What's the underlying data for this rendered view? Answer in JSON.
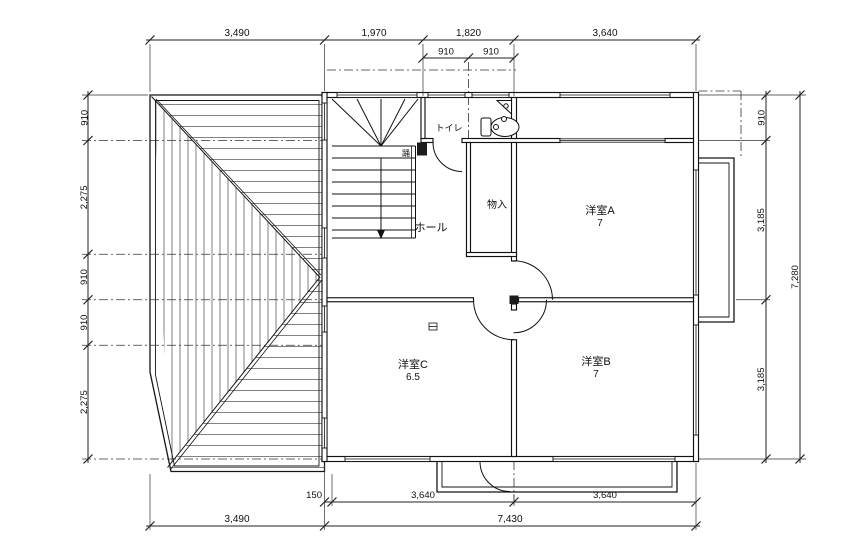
{
  "drawing": {
    "type": "architectural-floor-plan",
    "colors": {
      "line": "#1a1a1a",
      "background": "#ffffff"
    },
    "dims": {
      "top": [
        "3,490",
        "1,970",
        "1,820",
        "3,640"
      ],
      "top_sub": [
        "910",
        "910"
      ],
      "left": [
        "910",
        "2,275",
        "910",
        "910",
        "2,275"
      ],
      "right": [
        "910",
        "3,185",
        "3,185"
      ],
      "right_total": "7,280",
      "bottom_sub": [
        "150",
        "3,640",
        "3,640"
      ],
      "bottom": [
        "3,490",
        "7,430"
      ]
    },
    "rooms": {
      "toilet": "トイレ",
      "hall": "ホール",
      "storage": "物入",
      "room_a": "洋室A",
      "room_a_size": "7",
      "room_b": "洋室B",
      "room_b_size": "7",
      "room_c": "洋室C",
      "room_c_size": "6.5",
      "stair_note": "踊"
    }
  }
}
